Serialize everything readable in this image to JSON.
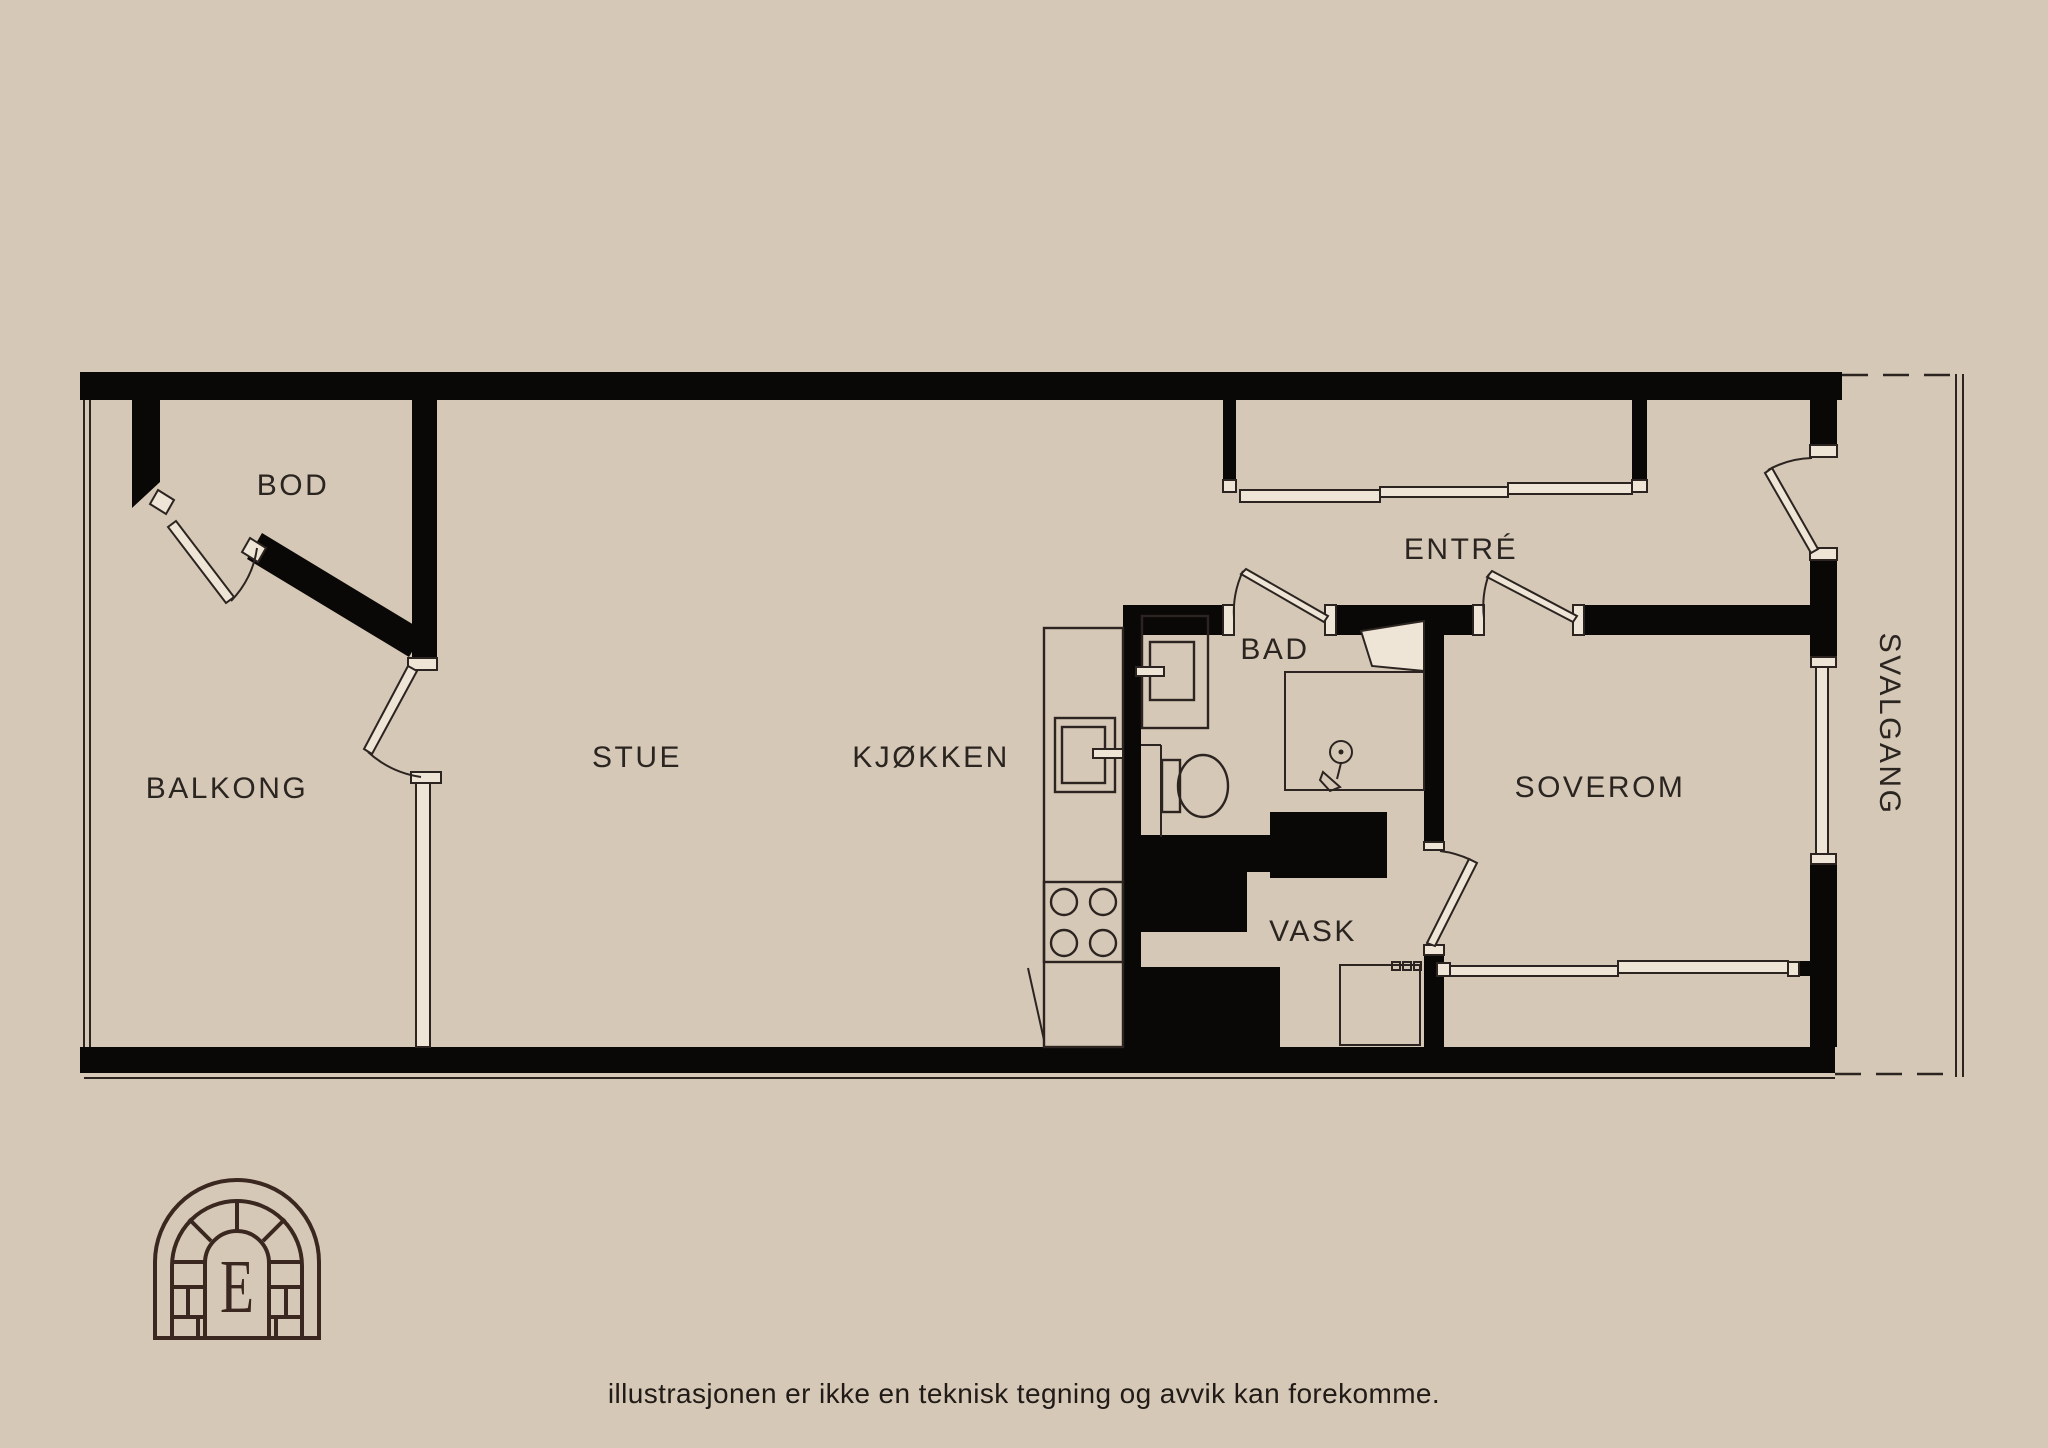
{
  "page": {
    "background": "#d6c8b6",
    "disclaimer": "illustrasjonen er ikke en teknisk tegning og avvik kan forekomme."
  },
  "floorplan": {
    "type": "apartment-floor-plan",
    "wall_color": "#0a0807",
    "line_color": "#2b2420",
    "label_color": "#2b2521",
    "rooms": {
      "bod": {
        "label": "BOD"
      },
      "balkong": {
        "label": "BALKONG"
      },
      "stue": {
        "label": "STUE"
      },
      "kjokken": {
        "label": "KJØKKEN"
      },
      "bad": {
        "label": "BAD"
      },
      "entre": {
        "label": "ENTRÉ"
      },
      "vask": {
        "label": "VASK"
      },
      "soverom": {
        "label": "SOVEROM"
      },
      "svalgang": {
        "label": "SVALGANG"
      }
    },
    "fixtures": [
      "kitchen-counter",
      "kitchen-sink-icon",
      "stove-icon",
      "bathroom-sink-icon",
      "toilet-icon",
      "shower-head-icon",
      "shower-screen",
      "washing-machine-icon",
      "radiator-window",
      "entry-windows",
      "doors"
    ],
    "logo": {
      "letter": "E",
      "color": "#3a2820"
    }
  }
}
